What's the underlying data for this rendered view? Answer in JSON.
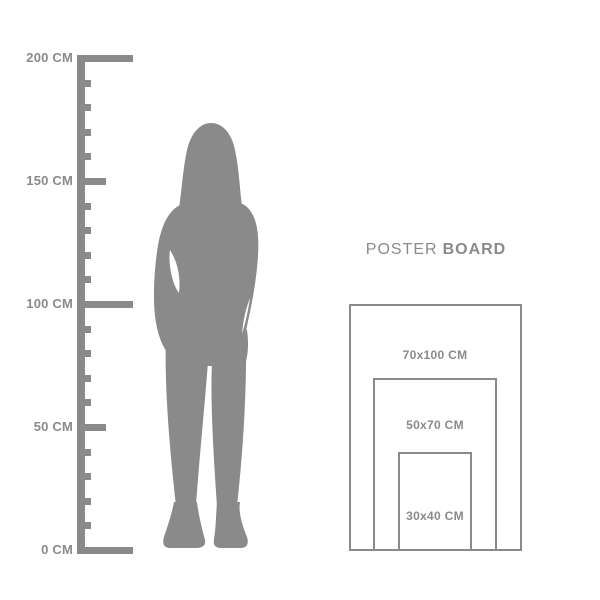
{
  "ruler": {
    "unit": "CM",
    "major_labels": [
      "200 CM",
      "150 CM",
      "100 CM",
      "50 CM",
      "0 CM"
    ],
    "major_values": [
      200,
      150,
      100,
      50,
      0
    ],
    "minor_step_cm": 10,
    "color": "#8a8a8a"
  },
  "figure": {
    "name": "woman-silhouette",
    "color": "#8a8a8a"
  },
  "poster_board": {
    "title_regular": "POSTER",
    "title_bold": "BOARD",
    "text_color": "#8a8a8a",
    "border_color": "#8a8a8a",
    "sizes": [
      {
        "label": "70x100 CM",
        "width_cm": 70,
        "height_cm": 100
      },
      {
        "label": "50x70 CM",
        "width_cm": 50,
        "height_cm": 70
      },
      {
        "label": "30x40 CM",
        "width_cm": 30,
        "height_cm": 40
      }
    ]
  }
}
